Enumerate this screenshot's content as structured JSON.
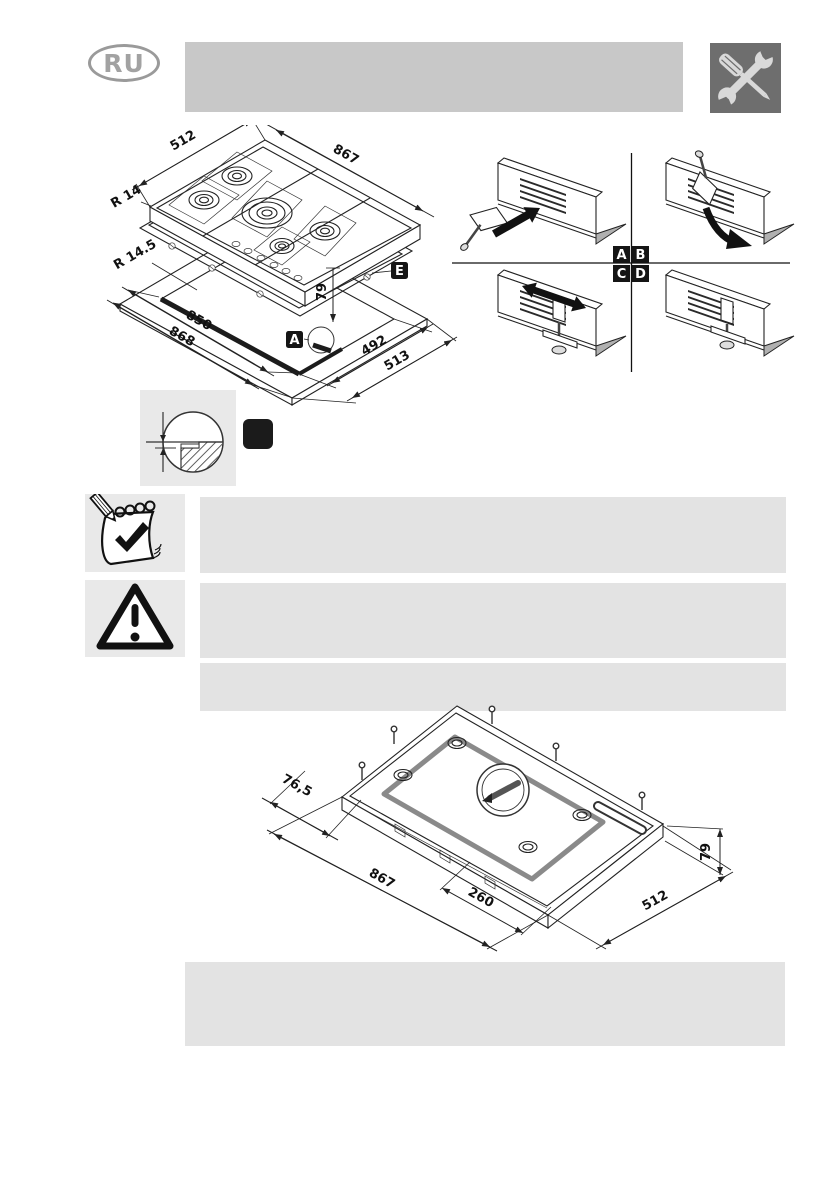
{
  "page": {
    "language_badge": "RU",
    "colors": {
      "header_bar": "#c8c8c8",
      "text_block": "#e3e3e3",
      "icon_block": "#e9e9e9",
      "tools_background": "#6e6e6e",
      "label_background": "#151515"
    }
  },
  "main_diagram": {
    "dim_width_top": "512",
    "dim_length_top": "867",
    "dim_radius_hob": "R 14",
    "dim_radius_cutout": "R 14.5",
    "dim_cutout_length": "850",
    "dim_panel_length": "868",
    "dim_cutout_width": "492",
    "dim_panel_width": "513",
    "dim_depth": "79",
    "label_seal": "E",
    "label_detail": "A"
  },
  "bracket_steps": {
    "step1": "A",
    "step2": "B",
    "step3": "C",
    "step4": "D"
  },
  "bottom_diagram": {
    "dim_offset": "76,5",
    "dim_length": "867",
    "dim_center": "260",
    "dim_width": "512",
    "dim_height": "79"
  }
}
